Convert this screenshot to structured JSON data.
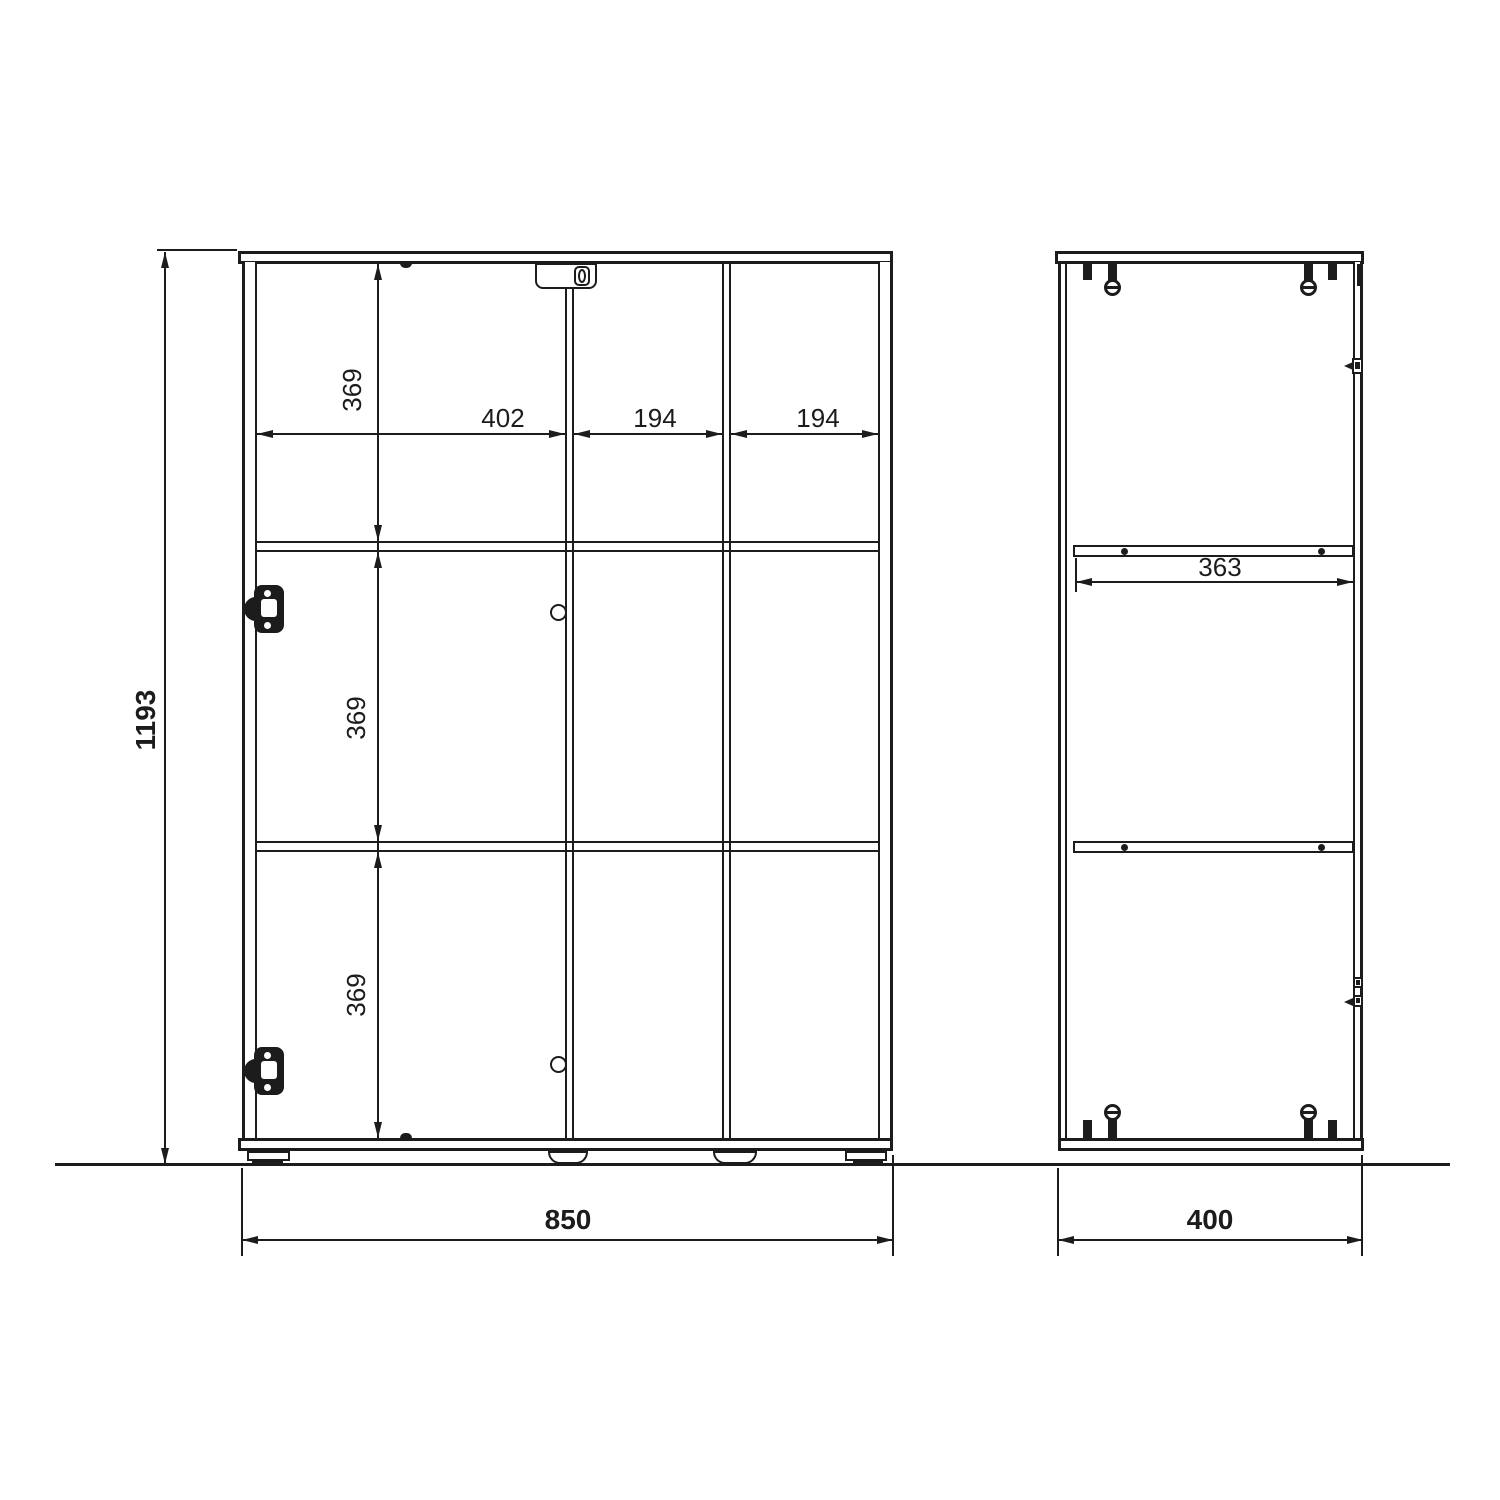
{
  "drawing": {
    "type": "furniture technical drawing, cabinet front and side elevation with dimensions (mm)",
    "front_view": {
      "height": "1193",
      "width": "850",
      "compartments": [
        "402",
        "194",
        "194"
      ],
      "rows": [
        "369",
        "369",
        "369"
      ]
    },
    "side_view": {
      "depth": "400",
      "shelf_depth": "363"
    },
    "line_color": "#1c1c1c",
    "background_color": "#ffffff"
  }
}
